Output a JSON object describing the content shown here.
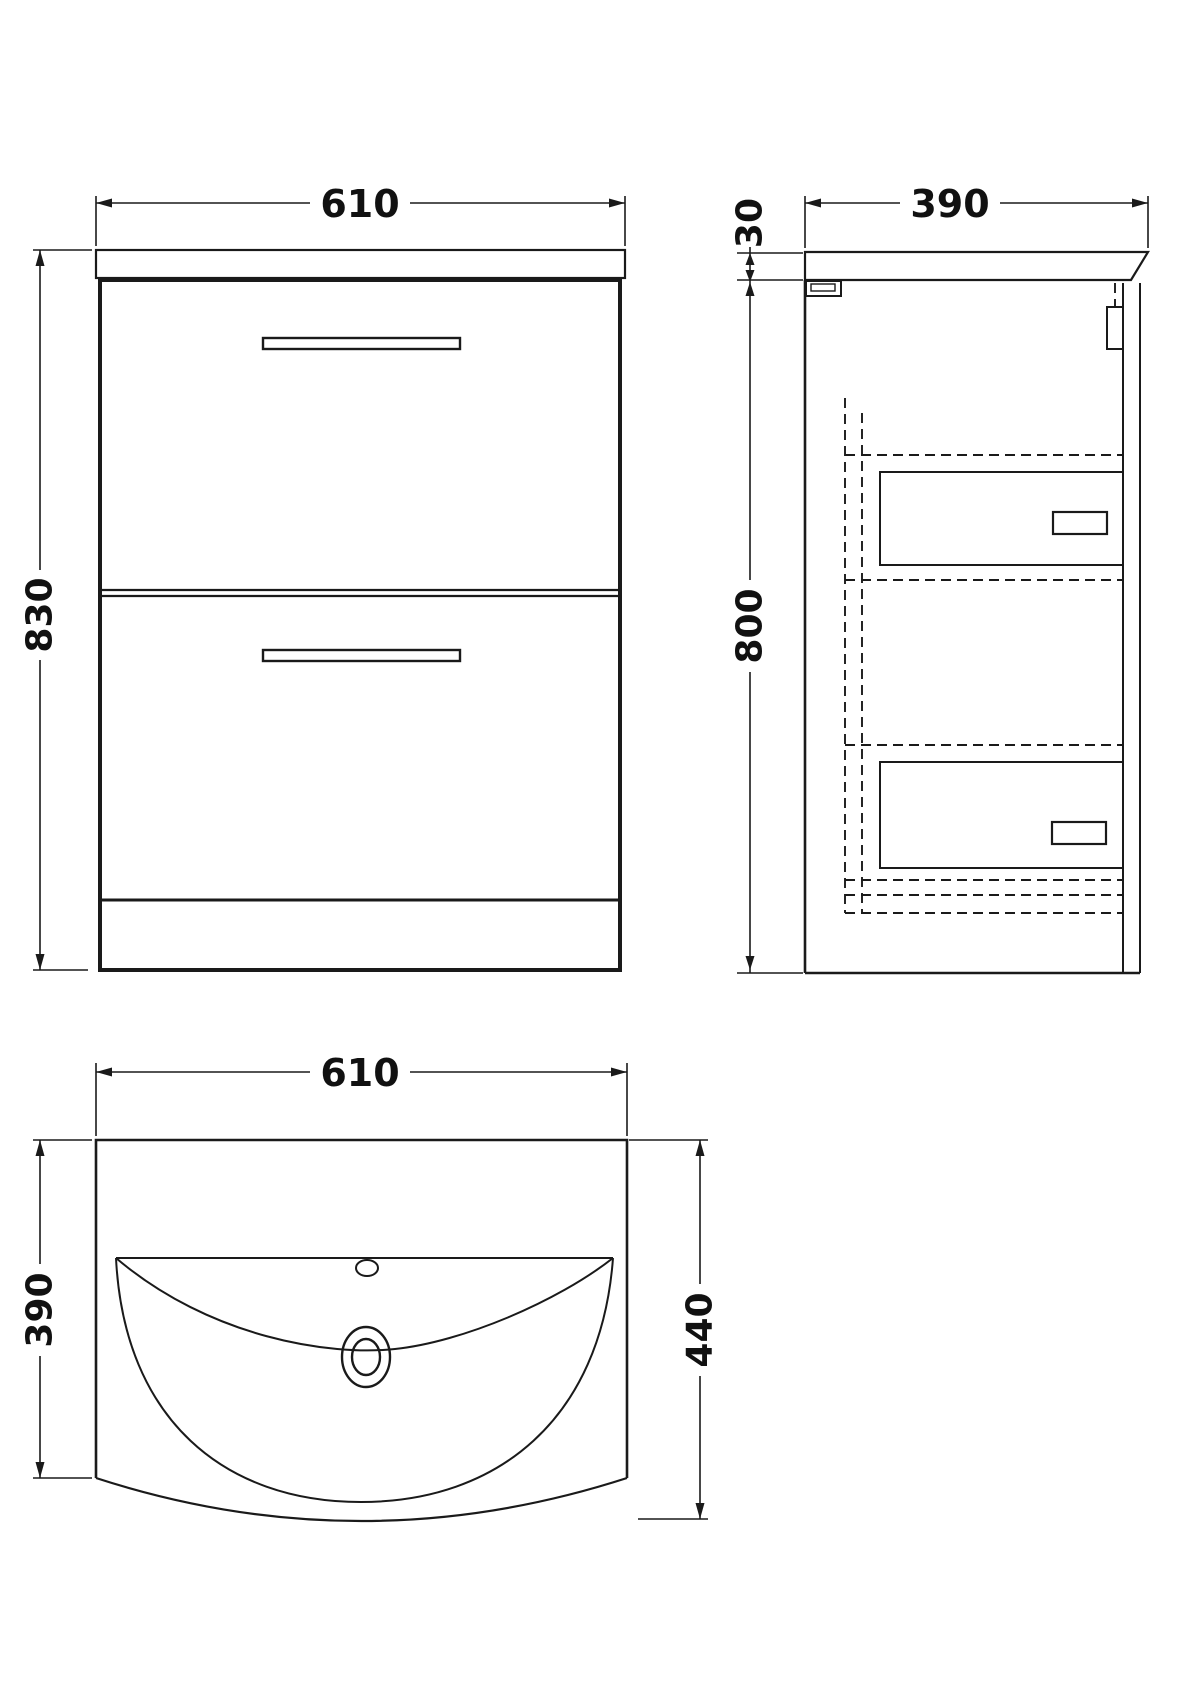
{
  "drawing": {
    "type": "technical-orthographic-drawing",
    "subject": "floor-standing vanity unit with basin",
    "line_color": "#1a1a1a",
    "background": "#ffffff",
    "views": {
      "front": {
        "label": "front elevation",
        "width_mm": "610",
        "height_mm": "830"
      },
      "side": {
        "label": "side elevation",
        "depth_mm": "390",
        "worktop_thickness_mm": "30",
        "carcass_height_mm": "800"
      },
      "plan": {
        "label": "plan view of basin",
        "width_mm": "610",
        "carcass_depth_mm": "390",
        "overall_depth_mm": "440"
      }
    }
  }
}
